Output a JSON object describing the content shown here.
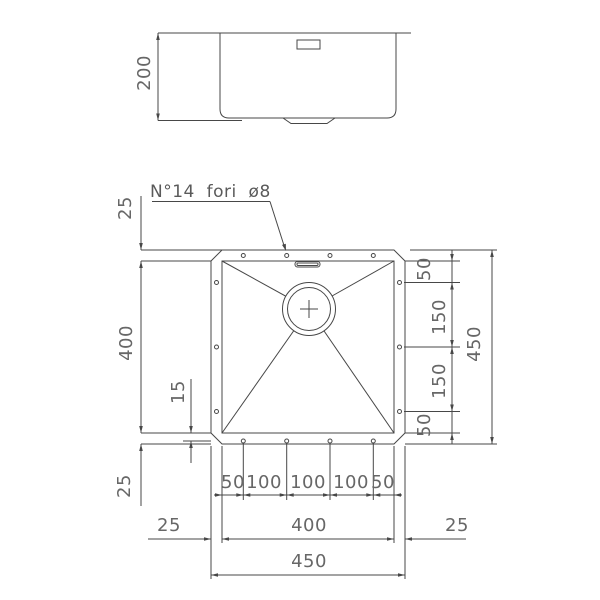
{
  "drawing": {
    "note": "N°14  fori  ø8",
    "side": {
      "height": "200"
    },
    "left": {
      "rim_top": "25",
      "bowl_height": "400",
      "hole_inset": "15",
      "rim_bottom": "25"
    },
    "right": {
      "seg_top": "50",
      "seg_mid1": "150",
      "seg_mid2": "150",
      "seg_bottom": "50",
      "overall": "450"
    },
    "bottom": {
      "hole_seg1": "50",
      "hole_seg2": "100",
      "hole_seg3": "100",
      "hole_seg4": "100",
      "hole_seg5": "50",
      "rim_left": "25",
      "bowl_width": "400",
      "rim_right": "25",
      "overall": "450"
    }
  }
}
